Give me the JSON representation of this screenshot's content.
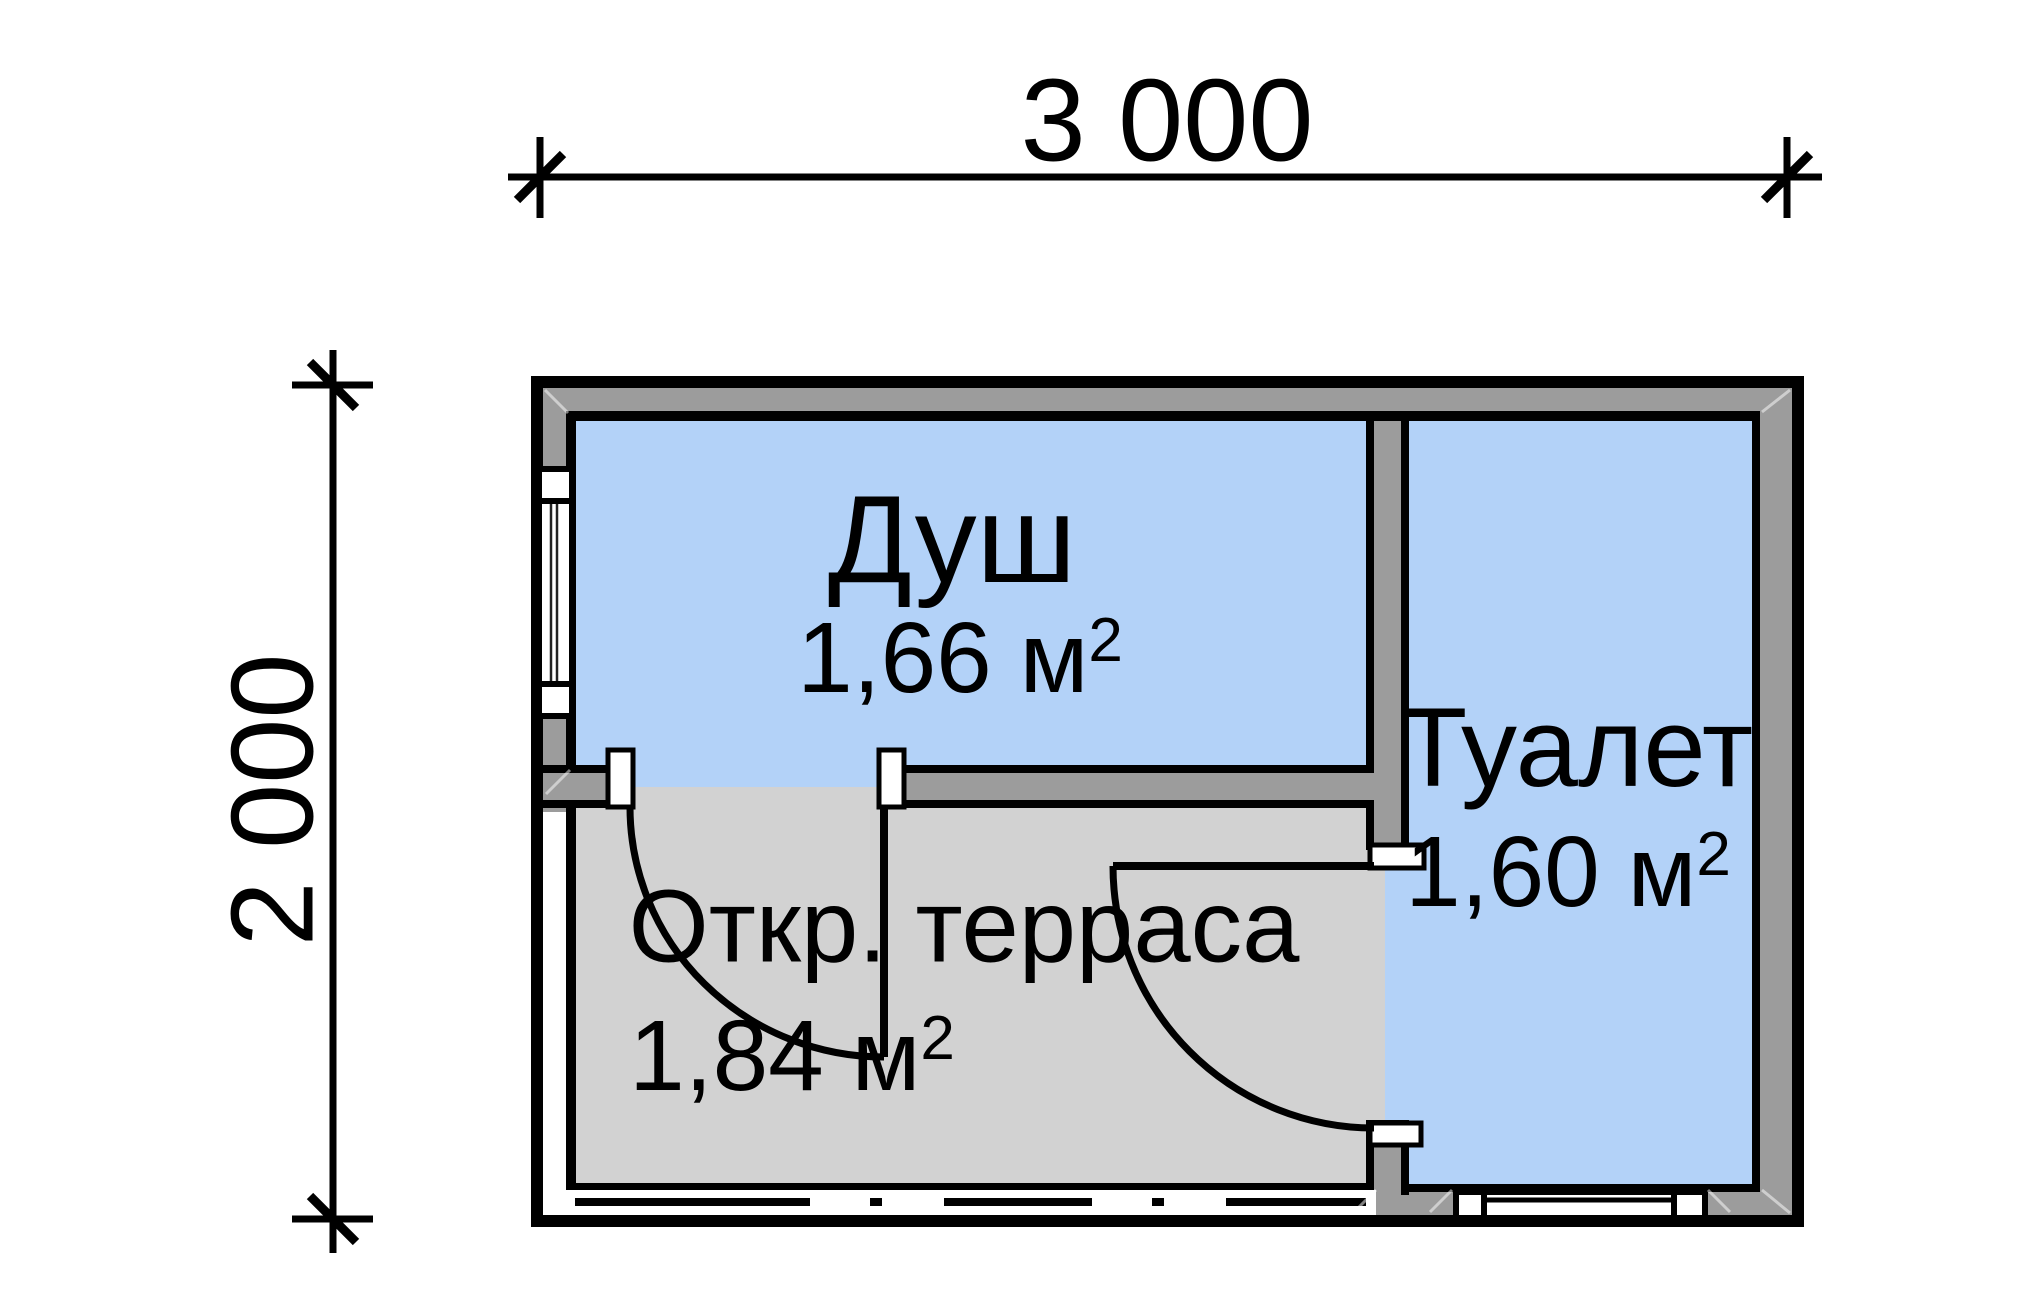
{
  "drawing": {
    "dimensions": {
      "width": {
        "label": "3 000"
      },
      "height": {
        "label": "2 000"
      }
    },
    "rooms": {
      "shower": {
        "name": "Душ",
        "area": "1,66 м",
        "area_sup": "2"
      },
      "toilet": {
        "name": "Туалет",
        "area": "1,60 м",
        "area_sup": "2"
      },
      "terrace": {
        "name": "Откр. терраса",
        "area": "1,84 м",
        "area_sup": "2"
      }
    },
    "colors": {
      "background": "#ffffff",
      "line": "#000000",
      "room_fill": "#b3d2f8",
      "wall_fill": "#9c9c9c",
      "terrace_fill": "#d2d2d2",
      "window_fill": "#ffffff"
    }
  }
}
